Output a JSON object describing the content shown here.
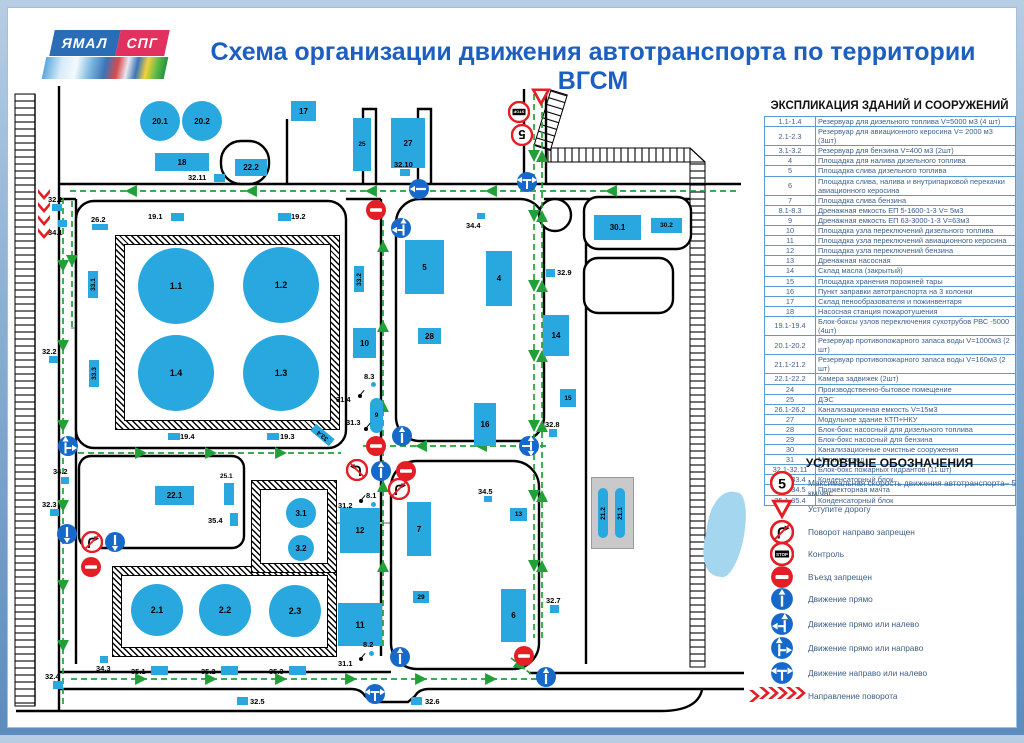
{
  "header": {
    "logo_line1": "ЯМАЛ",
    "logo_line2": "СПГ",
    "title": "Схема организации движения автотранспорта по территории ВГСМ"
  },
  "explication": {
    "title": "ЭКСПЛИКАЦИЯ ЗДАНИЙ И СООРУЖЕНИЙ",
    "rows": [
      {
        "num": "1.1-1.4",
        "desc": "Резервуар для дизельного топлива V=5000 м3 (4 шт)"
      },
      {
        "num": "2.1-2.3",
        "desc": "Резервуар для авиационного керосина V= 2000 м3 (3шт)"
      },
      {
        "num": "3.1-3.2",
        "desc": "Резервуар для бензина V=400 м3 (2шт)"
      },
      {
        "num": "4",
        "desc": "Площадка для налива дизельного топлива"
      },
      {
        "num": "5",
        "desc": "Площадка слива дизельного топлива"
      },
      {
        "num": "6",
        "desc": "Площадка слива, налива и внутрипарковой перекачки авиационного керосина"
      },
      {
        "num": "7",
        "desc": "Площадка слива бензина"
      },
      {
        "num": "8.1-8.3",
        "desc": "Дренажная емкость ЕП 5-1600-1-3 V= 5м3"
      },
      {
        "num": "9",
        "desc": "Дренажная емкость ЕП 63-3000-1-3 V=63м3"
      },
      {
        "num": "10",
        "desc": "Площадка узла переключений дизельного топлива"
      },
      {
        "num": "11",
        "desc": "Площадка узла переключений авиационного керосина"
      },
      {
        "num": "12",
        "desc": "Площадка узла переключений бензина"
      },
      {
        "num": "13",
        "desc": "Дренажная насосная"
      },
      {
        "num": "14",
        "desc": "Склад масла (закрытый)"
      },
      {
        "num": "15",
        "desc": "Площадка хранения порожней тары"
      },
      {
        "num": "16",
        "desc": "Пункт заправки автотранспорта на 3 колонки"
      },
      {
        "num": "17",
        "desc": "Склад пенообразователя и пожинвентаря"
      },
      {
        "num": "18",
        "desc": "Насосная станция пожаротушения"
      },
      {
        "num": "19.1-19.4",
        "desc": "Блок-боксы узлов переключения сухотрубов РВС -5000 (4шт)"
      },
      {
        "num": "20.1-20.2",
        "desc": "Резервуар противопожарного запаса воды V=1000м3 (2 шт)"
      },
      {
        "num": "21.1-21.2",
        "desc": "Резервуар противопожарного запаса воды V=160м3 (2 шт)"
      },
      {
        "num": "22.1-22.2",
        "desc": "Камера задвижек (2шт)"
      },
      {
        "num": "24",
        "desc": "Производственно-бытовое помещение"
      },
      {
        "num": "25",
        "desc": "ДЭС"
      },
      {
        "num": "26.1-26.2",
        "desc": "Канализационная емкость V=15м3"
      },
      {
        "num": "27",
        "desc": "Модульное здание КТП+НКУ"
      },
      {
        "num": "28",
        "desc": "Блок-бокс насосный для дизельного топлива"
      },
      {
        "num": "29",
        "desc": "Блок-бокс насосный  для бензина"
      },
      {
        "num": "30",
        "desc": "Канализационные очистные сооружения"
      },
      {
        "num": "31",
        "desc": "Молниеотвод"
      },
      {
        "num": "32.1-32.11",
        "desc": "Блок-бокс пожарных гидрантов (11 шт)"
      },
      {
        "num": "33.1-33.4",
        "desc": "Конденсаторный блок"
      },
      {
        "num": "34.1-34.5",
        "desc": "Прожекторная мачта"
      },
      {
        "num": "35.1-35.4",
        "desc": "Конденсаторный блок"
      }
    ]
  },
  "legend": {
    "title": "УСЛОВНЫЕ ОБОЗНАЧЕНИЯ",
    "items": [
      {
        "type": "speed-limit-5",
        "label": "Максимальная скорость движения автотранспорта– 5 км/час"
      },
      {
        "type": "give-way",
        "label": "Уступите дорогу"
      },
      {
        "type": "no-right-turn",
        "label": "Поворот направо запрещен"
      },
      {
        "type": "control",
        "label": "Контроль"
      },
      {
        "type": "no-entry",
        "label": "Въезд запрещен"
      },
      {
        "type": "straight",
        "label": "Движение прямо"
      },
      {
        "type": "straight-or-left",
        "label": "Движение прямо или налево"
      },
      {
        "type": "straight-or-right",
        "label": "Движение прямо или направо"
      },
      {
        "type": "right-or-left",
        "label": "Движение направо или налево"
      },
      {
        "type": "turn-direction",
        "label": "Направление поворота"
      }
    ]
  },
  "map": {
    "colors": {
      "building": "#29a8e0",
      "sign_blue": "#1668c9",
      "sign_red": "#e31e24",
      "route": "#21a038"
    },
    "buildings": [
      {
        "id": "20.1",
        "x": 132,
        "y": 93,
        "w": 40,
        "h": 40,
        "shape": "circle"
      },
      {
        "id": "20.2",
        "x": 174,
        "y": 93,
        "w": 40,
        "h": 40,
        "shape": "circle"
      },
      {
        "id": "17",
        "x": 283,
        "y": 93,
        "w": 25,
        "h": 20
      },
      {
        "id": "18",
        "x": 147,
        "y": 145,
        "w": 54,
        "h": 18
      },
      {
        "id": "22.2",
        "x": 227,
        "y": 151,
        "w": 32,
        "h": 17
      },
      {
        "id": "25",
        "x": 345,
        "y": 110,
        "w": 18,
        "h": 53
      },
      {
        "id": "27",
        "x": 383,
        "y": 110,
        "w": 34,
        "h": 50
      },
      {
        "id": "30.1",
        "x": 586,
        "y": 207,
        "w": 47,
        "h": 25
      },
      {
        "id": "30.2",
        "x": 643,
        "y": 210,
        "w": 31,
        "h": 15
      },
      {
        "id": "5",
        "x": 397,
        "y": 232,
        "w": 39,
        "h": 54
      },
      {
        "id": "4",
        "x": 478,
        "y": 243,
        "w": 26,
        "h": 55
      },
      {
        "id": "28",
        "x": 410,
        "y": 320,
        "w": 23,
        "h": 16
      },
      {
        "id": "10",
        "x": 345,
        "y": 320,
        "w": 23,
        "h": 30
      },
      {
        "id": "16",
        "x": 466,
        "y": 395,
        "w": 22,
        "h": 43
      },
      {
        "id": "14",
        "x": 535,
        "y": 307,
        "w": 26,
        "h": 41
      },
      {
        "id": "15",
        "x": 552,
        "y": 381,
        "w": 16,
        "h": 18
      },
      {
        "id": "9",
        "x": 362,
        "y": 390,
        "w": 13,
        "h": 35,
        "shape": "oval"
      },
      {
        "id": "12",
        "x": 332,
        "y": 500,
        "w": 40,
        "h": 45
      },
      {
        "id": "11",
        "x": 330,
        "y": 595,
        "w": 44,
        "h": 43
      },
      {
        "id": "7",
        "x": 399,
        "y": 494,
        "w": 24,
        "h": 54
      },
      {
        "id": "6",
        "x": 493,
        "y": 581,
        "w": 25,
        "h": 53
      },
      {
        "id": "13",
        "x": 502,
        "y": 500,
        "w": 17,
        "h": 13
      },
      {
        "id": "22.1",
        "x": 147,
        "y": 478,
        "w": 39,
        "h": 19
      },
      {
        "id": "25.1",
        "x": 216,
        "y": 475,
        "w": 10,
        "h": 22,
        "lpos": "above"
      },
      {
        "id": "29",
        "x": 405,
        "y": 583,
        "w": 16,
        "h": 12
      },
      {
        "id": "33.1",
        "x": 80,
        "y": 263,
        "w": 10,
        "h": 27,
        "rot": -90
      },
      {
        "id": "33.2",
        "x": 346,
        "y": 258,
        "w": 10,
        "h": 26,
        "rot": -90
      },
      {
        "id": "33.3",
        "x": 81,
        "y": 352,
        "w": 10,
        "h": 27,
        "rot": -90
      },
      {
        "id": "33.4",
        "x": 310,
        "y": 415,
        "w": 9,
        "h": 24,
        "rot": -90,
        "tilt": -50
      },
      {
        "id": "21.2",
        "x": 590,
        "y": 480,
        "w": 10,
        "h": 50,
        "rot": -90,
        "shape": "bar"
      },
      {
        "id": "21.1",
        "x": 607,
        "y": 480,
        "w": 10,
        "h": 50,
        "rot": -90,
        "shape": "bar"
      },
      {
        "id": "1.1",
        "x": 130,
        "y": 240,
        "w": 76,
        "h": 76,
        "shape": "circle"
      },
      {
        "id": "1.2",
        "x": 235,
        "y": 239,
        "w": 76,
        "h": 76,
        "shape": "circle"
      },
      {
        "id": "1.4",
        "x": 130,
        "y": 327,
        "w": 76,
        "h": 76,
        "shape": "circle"
      },
      {
        "id": "1.3",
        "x": 235,
        "y": 327,
        "w": 76,
        "h": 76,
        "shape": "circle"
      },
      {
        "id": "2.1",
        "x": 123,
        "y": 576,
        "w": 52,
        "h": 52,
        "shape": "circle"
      },
      {
        "id": "2.2",
        "x": 191,
        "y": 576,
        "w": 52,
        "h": 52,
        "shape": "circle"
      },
      {
        "id": "2.3",
        "x": 261,
        "y": 577,
        "w": 52,
        "h": 52,
        "shape": "circle"
      },
      {
        "id": "3.1",
        "x": 278,
        "y": 490,
        "w": 30,
        "h": 30,
        "shape": "circle"
      },
      {
        "id": "3.2",
        "x": 280,
        "y": 527,
        "w": 26,
        "h": 26,
        "shape": "circle"
      }
    ],
    "point_labels": [
      {
        "t": "32.1",
        "x": 40,
        "y": 187,
        "m": [
          44,
          196,
          10,
          7
        ]
      },
      {
        "t": "34.1",
        "x": 40,
        "y": 220,
        "m": [
          50,
          212,
          9,
          7
        ]
      },
      {
        "t": "26.2",
        "x": 83,
        "y": 207,
        "m": [
          84,
          216,
          16,
          6
        ]
      },
      {
        "t": "19.1",
        "x": 140,
        "y": 204,
        "m": [
          163,
          205,
          13,
          8
        ]
      },
      {
        "t": "19.2",
        "x": 283,
        "y": 204,
        "m": [
          270,
          205,
          13,
          8
        ]
      },
      {
        "t": "32.11",
        "x": 180,
        "y": 165,
        "m": [
          206,
          166,
          11,
          8
        ]
      },
      {
        "t": "32.10",
        "x": 386,
        "y": 152,
        "m": [
          392,
          161,
          10,
          7
        ]
      },
      {
        "t": "34.4",
        "x": 458,
        "y": 213,
        "m": [
          469,
          205,
          8,
          6
        ]
      },
      {
        "t": "32.9",
        "x": 549,
        "y": 260,
        "m": [
          538,
          261,
          9,
          8
        ]
      },
      {
        "t": "19.4",
        "x": 172,
        "y": 424,
        "m": [
          160,
          425,
          12,
          7
        ]
      },
      {
        "t": "19.3",
        "x": 272,
        "y": 424,
        "m": [
          259,
          425,
          12,
          7
        ]
      },
      {
        "t": "31.4",
        "x": 328,
        "y": 387,
        "flag": [
          350,
          386
        ]
      },
      {
        "t": "31.3",
        "x": 338,
        "y": 410,
        "flag": [
          356,
          419
        ]
      },
      {
        "t": "8.3",
        "x": 356,
        "y": 364,
        "dot": [
          363,
          374
        ]
      },
      {
        "t": "8.1",
        "x": 358,
        "y": 483,
        "dot": [
          363,
          494
        ]
      },
      {
        "t": "8.2",
        "x": 355,
        "y": 632,
        "dot": [
          361,
          643
        ]
      },
      {
        "t": "31.2",
        "x": 330,
        "y": 493,
        "flag": [
          351,
          491
        ]
      },
      {
        "t": "31.1",
        "x": 330,
        "y": 651,
        "flag": [
          351,
          649
        ]
      },
      {
        "t": "34.2",
        "x": 45,
        "y": 459,
        "m": [
          53,
          469,
          8,
          7
        ]
      },
      {
        "t": "32.3",
        "x": 34,
        "y": 492,
        "m": [
          42,
          501,
          9,
          7
        ]
      },
      {
        "t": "32.2",
        "x": 34,
        "y": 339,
        "m": [
          41,
          348,
          9,
          7
        ]
      },
      {
        "t": "32.4",
        "x": 37,
        "y": 664,
        "m": [
          45,
          673,
          10,
          8
        ]
      },
      {
        "t": "34.3",
        "x": 88,
        "y": 656,
        "m": [
          92,
          648,
          8,
          7
        ]
      },
      {
        "t": "35.1",
        "x": 123,
        "y": 659,
        "m": [
          143,
          658,
          17,
          9
        ]
      },
      {
        "t": "35.2",
        "x": 193,
        "y": 659,
        "m": [
          213,
          658,
          17,
          9
        ]
      },
      {
        "t": "35.3",
        "x": 261,
        "y": 659,
        "m": [
          281,
          658,
          17,
          9
        ]
      },
      {
        "t": "35.4",
        "x": 200,
        "y": 508,
        "m": [
          222,
          505,
          8,
          13
        ]
      },
      {
        "t": "32.5",
        "x": 242,
        "y": 689,
        "m": [
          229,
          689,
          11,
          8
        ]
      },
      {
        "t": "32.6",
        "x": 417,
        "y": 689,
        "m": [
          403,
          689,
          11,
          8
        ]
      },
      {
        "t": "32.7",
        "x": 538,
        "y": 588,
        "m": [
          542,
          597,
          9,
          8
        ]
      },
      {
        "t": "32.8",
        "x": 537,
        "y": 412,
        "m": [
          541,
          421,
          8,
          8
        ]
      },
      {
        "t": "34.5",
        "x": 470,
        "y": 479,
        "m": [
          476,
          488,
          8,
          6
        ]
      }
    ],
    "signs": [
      {
        "t": "give-way",
        "x": 533,
        "y": 89
      },
      {
        "t": "control",
        "x": 511,
        "y": 104,
        "r": 180
      },
      {
        "t": "speed-limit-5",
        "x": 514,
        "y": 127,
        "r": 180
      },
      {
        "t": "right-or-left",
        "x": 519,
        "y": 174
      },
      {
        "t": "straight",
        "x": 411,
        "y": 181,
        "r": 270
      },
      {
        "t": "no-entry",
        "x": 368,
        "y": 202
      },
      {
        "t": "straight-or-left",
        "x": 393,
        "y": 220
      },
      {
        "t": "no-entry",
        "x": 368,
        "y": 438
      },
      {
        "t": "straight",
        "x": 394,
        "y": 428
      },
      {
        "t": "right-or-left",
        "x": 521,
        "y": 438,
        "r": 90
      },
      {
        "t": "no-right-turn",
        "x": 349,
        "y": 462,
        "fx": 1
      },
      {
        "t": "straight",
        "x": 373,
        "y": 463
      },
      {
        "t": "no-entry",
        "x": 398,
        "y": 463
      },
      {
        "t": "no-right-turn",
        "x": 391,
        "y": 481
      },
      {
        "t": "straight-or-right",
        "x": 60,
        "y": 438
      },
      {
        "t": "straight",
        "x": 59,
        "y": 526,
        "r": 180
      },
      {
        "t": "no-right-turn",
        "x": 84,
        "y": 534
      },
      {
        "t": "straight",
        "x": 107,
        "y": 534,
        "r": 180
      },
      {
        "t": "no-entry",
        "x": 83,
        "y": 559
      },
      {
        "t": "straight",
        "x": 392,
        "y": 649
      },
      {
        "t": "right-or-left",
        "x": 367,
        "y": 686
      },
      {
        "t": "no-entry",
        "x": 516,
        "y": 648
      },
      {
        "t": "straight",
        "x": 538,
        "y": 669
      }
    ],
    "chevrons": [
      {
        "x": 36,
        "y": 186,
        "r": 90
      },
      {
        "x": 36,
        "y": 199,
        "r": 90
      },
      {
        "x": 36,
        "y": 212,
        "r": 90
      },
      {
        "x": 36,
        "y": 225,
        "r": 90
      },
      {
        "x": 746,
        "y": 688,
        "r": 0
      }
    ]
  }
}
